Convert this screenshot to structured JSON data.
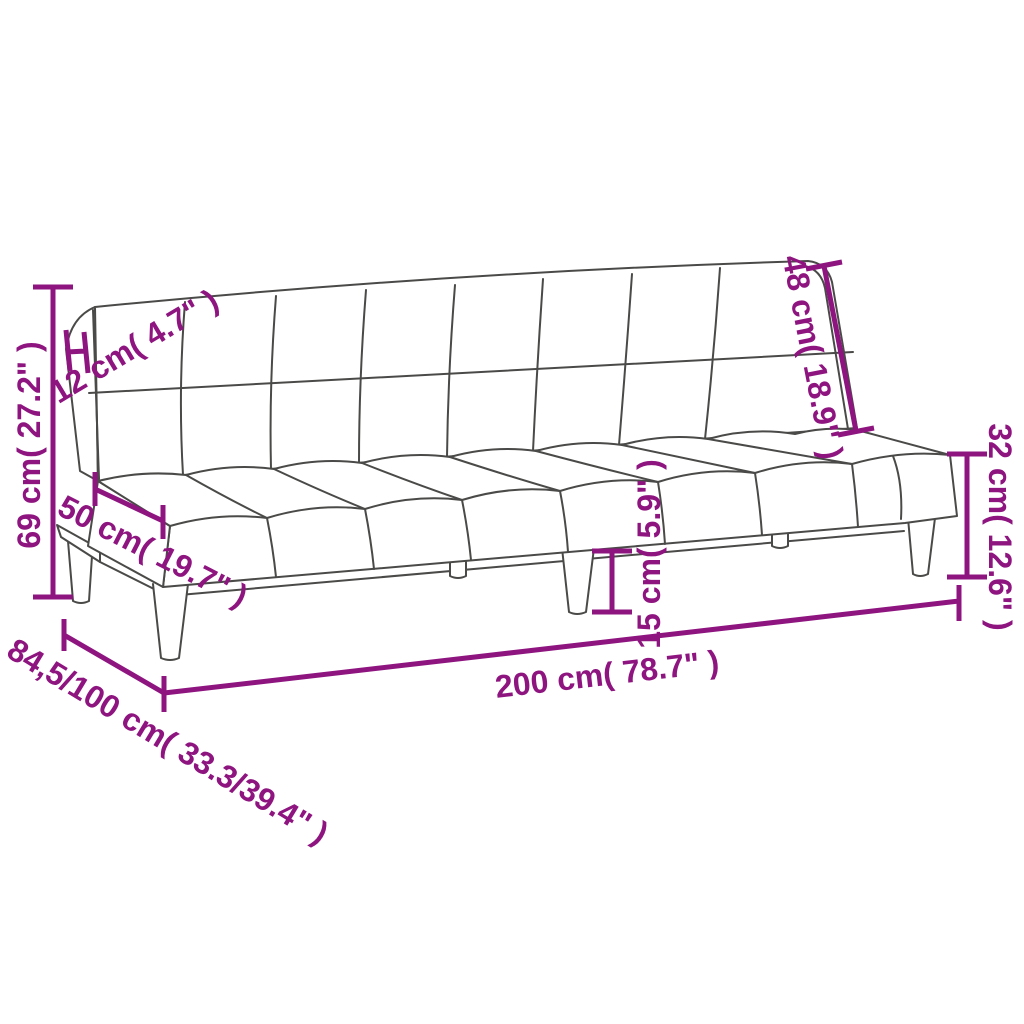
{
  "diagram": {
    "type": "product-dimension-line-drawing",
    "subject": "armless sofa bed (futon) with tufted backrest and seat",
    "colors": {
      "dimension_accent": "#8E1480",
      "line_art": "#4a4a48",
      "background": "#ffffff"
    },
    "measurements": {
      "overall_height": "69 cm( 27.2\" )",
      "backrest_thickness": "12 cm( 4.7\" )",
      "seat_depth": "50 cm( 19.7\" )",
      "backrest_height": "48 cm( 18.9\" )",
      "seat_height": "32 cm( 12.6\" )",
      "leg_height": "15 cm( 5.9\" )",
      "overall_width": "200 cm( 78.7\" )",
      "overall_depth": "84,5/100 cm( 33.3/39.4\" )"
    }
  }
}
